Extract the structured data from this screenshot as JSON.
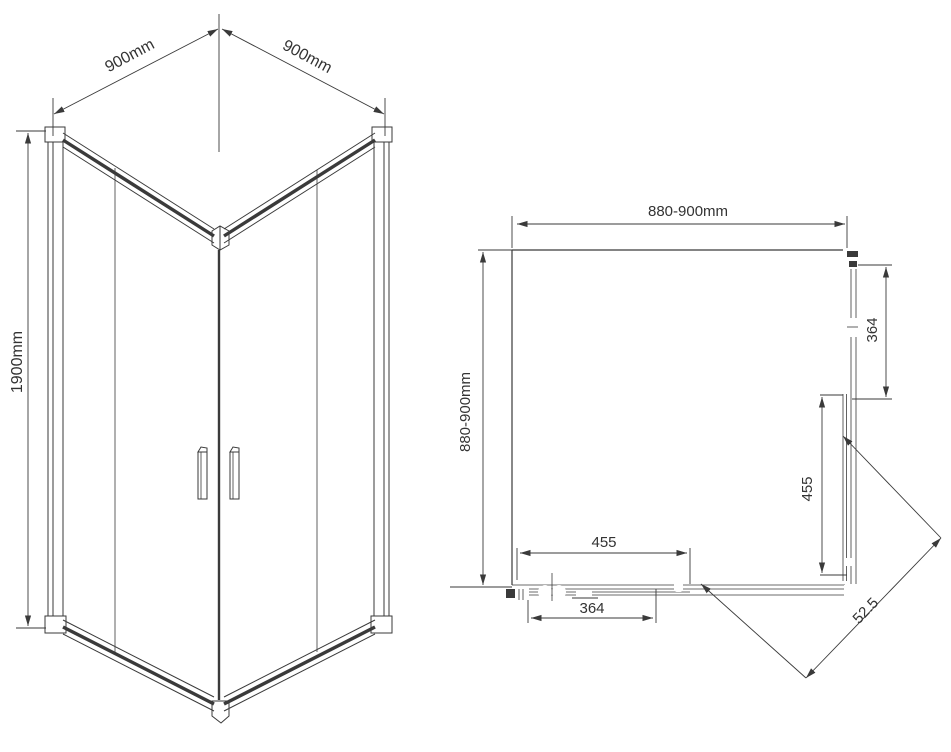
{
  "iso_view": {
    "label_width_left": "900mm",
    "label_width_right": "900mm",
    "label_height": "1900mm"
  },
  "plan_view": {
    "label_width_top": "880-900mm",
    "label_depth_left": "880-900mm",
    "label_right_fixed_panel": "364",
    "label_right_door": "455",
    "label_bottom_door": "455",
    "label_bottom_fixed_panel": "364",
    "label_diagonal_entry": "52.5"
  },
  "colors": {
    "line": "#3a3a3a",
    "text": "#333333",
    "background": "#ffffff"
  }
}
